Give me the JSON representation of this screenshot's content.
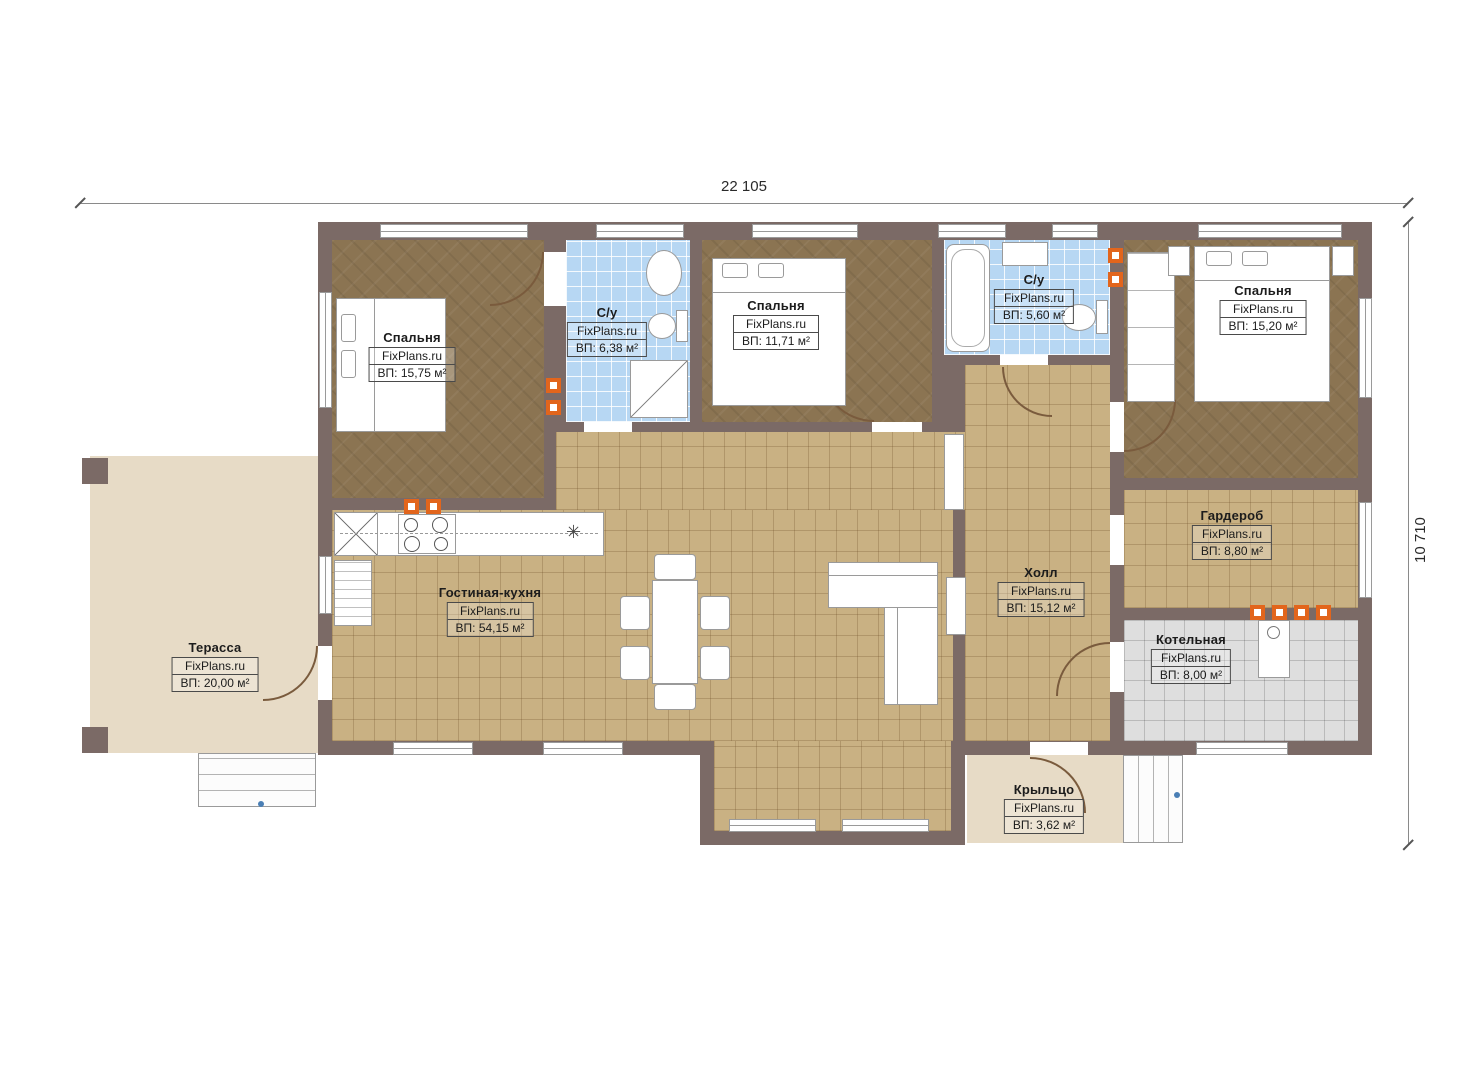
{
  "dimensions": {
    "width_mm": "22 105",
    "height_mm": "10 710"
  },
  "icons": {
    "sink_star": "✳"
  },
  "rooms": [
    {
      "name": "Спальня",
      "brand": "FixPlans.ru",
      "area": "ВП: 15,75 м²"
    },
    {
      "name": "С/у",
      "brand": "FixPlans.ru",
      "area": "ВП: 6,38 м²"
    },
    {
      "name": "Спальня",
      "brand": "FixPlans.ru",
      "area": "ВП: 11,71 м²"
    },
    {
      "name": "С/у",
      "brand": "FixPlans.ru",
      "area": "ВП: 5,60 м²"
    },
    {
      "name": "Спальня",
      "brand": "FixPlans.ru",
      "area": "ВП: 15,20 м²"
    },
    {
      "name": "Гостиная-кухня",
      "brand": "FixPlans.ru",
      "area": "ВП: 54,15 м²"
    },
    {
      "name": "Холл",
      "brand": "FixPlans.ru",
      "area": "ВП: 15,12 м²"
    },
    {
      "name": "Гардероб",
      "brand": "FixPlans.ru",
      "area": "ВП: 8,80 м²"
    },
    {
      "name": "Котельная",
      "brand": "FixPlans.ru",
      "area": "ВП: 8,00 м²"
    },
    {
      "name": "Терасса",
      "brand": "FixPlans.ru",
      "area": "ВП: 20,00 м²"
    },
    {
      "name": "Крыльцо",
      "brand": "FixPlans.ru",
      "area": "ВП: 3,62 м²"
    }
  ],
  "colors": {
    "wall": "#7b6a66",
    "bedroom_floor": "#8b7452",
    "tile_floor": "#c9b183",
    "bath_tile": "#b7d7f3",
    "boiler_tile": "#dedede",
    "outdoor": "#e7dbc6",
    "accent_vent": "#e2651c"
  }
}
